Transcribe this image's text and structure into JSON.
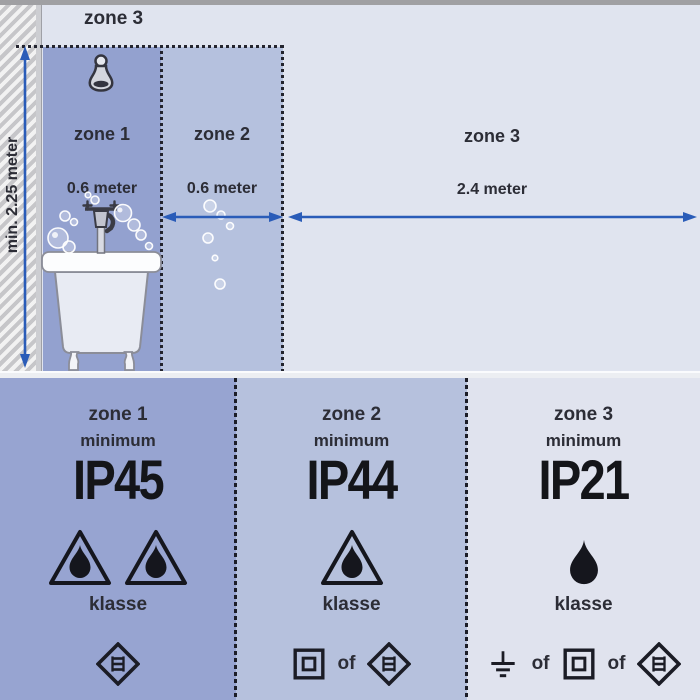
{
  "colors": {
    "zone1_fill": "#93a1cf",
    "zone2_fill": "#b5c1de",
    "zone3_fill": "#e0e4ef",
    "arrow_blue": "#2a5cb8",
    "label_dark": "#2c2d36",
    "ip_text": "#141519"
  },
  "top_diagram": {
    "outer_zone_label": "zone 3",
    "wall_height_label": "min. 2.25 meter",
    "zones": [
      {
        "label": "zone 1",
        "width_label": "0.6 meter"
      },
      {
        "label": "zone 2",
        "width_label": "0.6 meter"
      },
      {
        "label": "zone 3",
        "width_label": "2.4 meter"
      }
    ],
    "icons": [
      "shower-head-icon",
      "bath-faucet-icon",
      "bathtub-icon",
      "soap-bubbles"
    ]
  },
  "panels": [
    {
      "zone": "zone 1",
      "minimum": "minimum",
      "ip_rating": "IP45",
      "klasse": "klasse",
      "protection_icons": [
        "triangle-drop-icon",
        "triangle-drop-icon"
      ],
      "class_icons": [
        "class-iii-diamond-icon"
      ]
    },
    {
      "zone": "zone 2",
      "minimum": "minimum",
      "ip_rating": "IP44",
      "klasse": "klasse",
      "of": "of",
      "protection_icons": [
        "triangle-drop-icon"
      ],
      "class_icons": [
        "class-ii-square-icon",
        "class-iii-diamond-icon"
      ]
    },
    {
      "zone": "zone 3",
      "minimum": "minimum",
      "ip_rating": "IP21",
      "klasse": "klasse",
      "of": "of",
      "protection_icons": [
        "drop-icon"
      ],
      "class_icons": [
        "earth-ground-icon",
        "class-ii-square-icon",
        "class-iii-diamond-icon"
      ]
    }
  ]
}
